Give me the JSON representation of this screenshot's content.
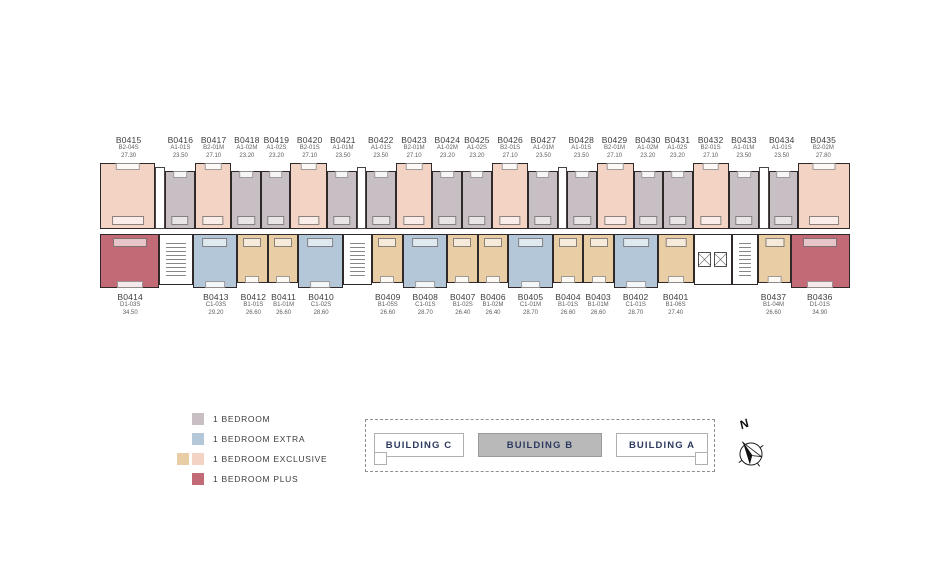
{
  "floorplan": {
    "top_row": [
      {
        "id": "B0415",
        "type": "B2-04S",
        "area": "27.30",
        "cat": "exclusive-b2",
        "w": 62
      },
      {
        "core": "shaft",
        "w": 9
      },
      {
        "id": "B0416",
        "type": "A1-01S",
        "area": "23.50",
        "cat": "bedroom",
        "w": 32
      },
      {
        "id": "B0417",
        "type": "B2-01M",
        "area": "27.10",
        "cat": "exclusive-b2",
        "w": 40
      },
      {
        "id": "B0418",
        "type": "A1-02M",
        "area": "23.20",
        "cat": "bedroom",
        "w": 32
      },
      {
        "id": "B0419",
        "type": "A1-02S",
        "area": "23.20",
        "cat": "bedroom",
        "w": 32
      },
      {
        "id": "B0420",
        "type": "B2-01S",
        "area": "27.10",
        "cat": "exclusive-b2",
        "w": 40
      },
      {
        "id": "B0421",
        "type": "A1-01M",
        "area": "23.50",
        "cat": "bedroom",
        "w": 32
      },
      {
        "core": "shaft",
        "w": 9
      },
      {
        "id": "B0422",
        "type": "A1-01S",
        "area": "23.50",
        "cat": "bedroom",
        "w": 32
      },
      {
        "id": "B0423",
        "type": "B2-01M",
        "area": "27.10",
        "cat": "exclusive-b2",
        "w": 40
      },
      {
        "id": "B0424",
        "type": "A1-02M",
        "area": "23.20",
        "cat": "bedroom",
        "w": 32
      },
      {
        "id": "B0425",
        "type": "A1-02S",
        "area": "23.20",
        "cat": "bedroom",
        "w": 32
      },
      {
        "id": "B0426",
        "type": "B2-01S",
        "area": "27.10",
        "cat": "exclusive-b2",
        "w": 40
      },
      {
        "id": "B0427",
        "type": "A1-01M",
        "area": "23.50",
        "cat": "bedroom",
        "w": 32
      },
      {
        "core": "shaft",
        "w": 9
      },
      {
        "id": "B0428",
        "type": "A1-01S",
        "area": "23.50",
        "cat": "bedroom",
        "w": 32
      },
      {
        "id": "B0429",
        "type": "B2-01M",
        "area": "27.10",
        "cat": "exclusive-b2",
        "w": 40
      },
      {
        "id": "B0430",
        "type": "A1-02M",
        "area": "23.20",
        "cat": "bedroom",
        "w": 32
      },
      {
        "id": "B0431",
        "type": "A1-02S",
        "area": "23.20",
        "cat": "bedroom",
        "w": 32
      },
      {
        "id": "B0432",
        "type": "B2-01S",
        "area": "27.10",
        "cat": "exclusive-b2",
        "w": 40
      },
      {
        "id": "B0433",
        "type": "A1-01M",
        "area": "23.50",
        "cat": "bedroom",
        "w": 32
      },
      {
        "core": "shaft",
        "w": 9
      },
      {
        "id": "B0434",
        "type": "A1-01S",
        "area": "23.50",
        "cat": "bedroom",
        "w": 32
      },
      {
        "id": "B0435",
        "type": "B2-02M",
        "area": "27.80",
        "cat": "exclusive-b2",
        "w": 58
      }
    ],
    "bottom_row": [
      {
        "id": "B0414",
        "type": "D1-03S",
        "area": "34.50",
        "cat": "plus",
        "w": 62
      },
      {
        "core": "stairs",
        "w": 34
      },
      {
        "id": "B0413",
        "type": "C1-03S",
        "area": "29.20",
        "cat": "extra",
        "w": 46
      },
      {
        "id": "B0412",
        "type": "B1-01S",
        "area": "26.60",
        "cat": "exclusive-b1",
        "w": 31
      },
      {
        "id": "B0411",
        "type": "B1-01M",
        "area": "26.60",
        "cat": "exclusive-b1",
        "w": 31
      },
      {
        "id": "B0410",
        "type": "C1-02S",
        "area": "28.60",
        "cat": "extra",
        "w": 46
      },
      {
        "core": "stairs",
        "w": 30
      },
      {
        "id": "B0409",
        "type": "B1-05S",
        "area": "26.60",
        "cat": "exclusive-b1",
        "w": 31
      },
      {
        "id": "B0408",
        "type": "C1-01S",
        "area": "28.70",
        "cat": "extra",
        "w": 46
      },
      {
        "id": "B0407",
        "type": "B1-02S",
        "area": "26.40",
        "cat": "exclusive-b1",
        "w": 31
      },
      {
        "id": "B0406",
        "type": "B1-02M",
        "area": "26.40",
        "cat": "exclusive-b1",
        "w": 31
      },
      {
        "id": "B0405",
        "type": "C1-01M",
        "area": "28.70",
        "cat": "extra",
        "w": 46
      },
      {
        "id": "B0404",
        "type": "B1-01S",
        "area": "26.60",
        "cat": "exclusive-b1",
        "w": 31
      },
      {
        "id": "B0403",
        "type": "B1-01M",
        "area": "26.60",
        "cat": "exclusive-b1",
        "w": 31
      },
      {
        "id": "B0402",
        "type": "C1-01S",
        "area": "28.70",
        "cat": "extra",
        "w": 46
      },
      {
        "id": "B0401",
        "type": "B1-06S",
        "area": "27.40",
        "cat": "exclusive-b1",
        "w": 36
      },
      {
        "core": "elevator",
        "w": 40
      },
      {
        "core": "stairs",
        "w": 26
      },
      {
        "id": "B0437",
        "type": "B1-04M",
        "area": "26.60",
        "cat": "exclusive-b1",
        "w": 33
      },
      {
        "id": "B0436",
        "type": "D1-01S",
        "area": "34.90",
        "cat": "plus",
        "w": 62
      }
    ],
    "colors": {
      "bedroom": "#c7bfc3",
      "extra": "#b4c7d9",
      "exclusive-b1": "#e9cda5",
      "exclusive-b2": "#f2d3c4",
      "plus": "#c26b77",
      "wall": "#2f2929"
    }
  },
  "legend": {
    "items": [
      {
        "label": "1 BEDROOM",
        "swatches": [
          "#c7bfc3"
        ]
      },
      {
        "label": "1 BEDROOM EXTRA",
        "swatches": [
          "#b4c7d9"
        ]
      },
      {
        "label": "1 BEDROOM EXCLUSIVE",
        "swatches": [
          "#e9cda5",
          "#f2d3c4"
        ]
      },
      {
        "label": "1 BEDROOM PLUS",
        "swatches": [
          "#c26b77"
        ]
      }
    ]
  },
  "locator": {
    "buildings": [
      {
        "label": "BUILDING C",
        "highlighted": false,
        "wing": "left"
      },
      {
        "label": "BUILDING B",
        "highlighted": true,
        "wing": null
      },
      {
        "label": "BUILDING A",
        "highlighted": false,
        "wing": "right"
      }
    ],
    "highlight_fill": "#b9b9b9",
    "label_color": "#2d3a5f"
  },
  "compass": {
    "label": "N"
  }
}
